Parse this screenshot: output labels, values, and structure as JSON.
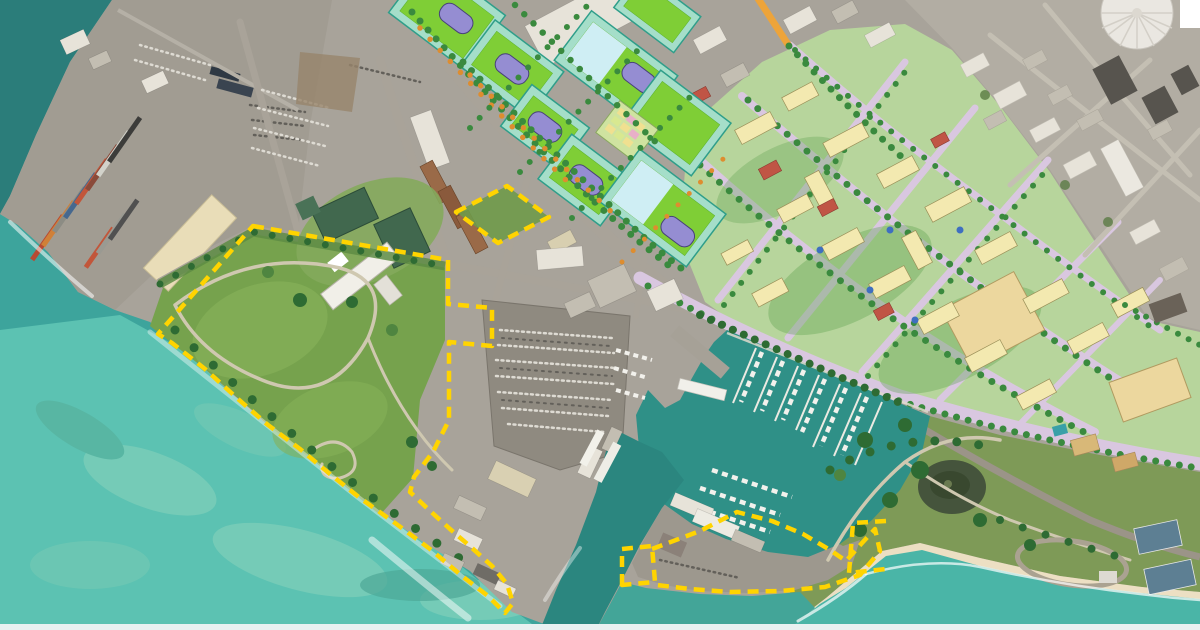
{
  "palette": {
    "ocean_deep": "#2b7d7a",
    "ocean_mid": "#3da49c",
    "ocean_shallow": "#5ec4b4",
    "reef_light": "#8fd4bd",
    "marina_water": "#2f9087",
    "channel_water": "#2b867f",
    "cove_water": "#4ab5a7",
    "land_base": "#a8a39a",
    "port_pavement": "#a19c92",
    "satellite_city": "#b2ada3",
    "plan_base": "#b7d59c",
    "field_border_mint": "#a5dec9",
    "field_border_edge": "#2f9e8a",
    "field_green": "#7fce36",
    "pool_blue": "#cfeef4",
    "civic_purple": "#958dd2",
    "plan_building_yellow": "#f3e9b0",
    "plan_big_building_tan": "#ecd79e",
    "plan_street_lavender": "#d9c7e0",
    "red_roof": "#c05545",
    "park_green": "#76a24d",
    "park_olive": "#7e9a57",
    "campus_roof_green": "#41684e",
    "warehouse_cream": "#e9ddb8",
    "beach_sand": "#ecdfc3",
    "surf_white": "#ffffff",
    "boundary_yellow": "#ffd400",
    "orange_road": "#eda43a",
    "bottom_strip": "#e8f1f1",
    "dome_white": "#eae7e1"
  },
  "features": {
    "boundary_style": "dashed",
    "boundary_parcels": 4,
    "planned_field_blocks": 9,
    "marina_piers": 7
  }
}
